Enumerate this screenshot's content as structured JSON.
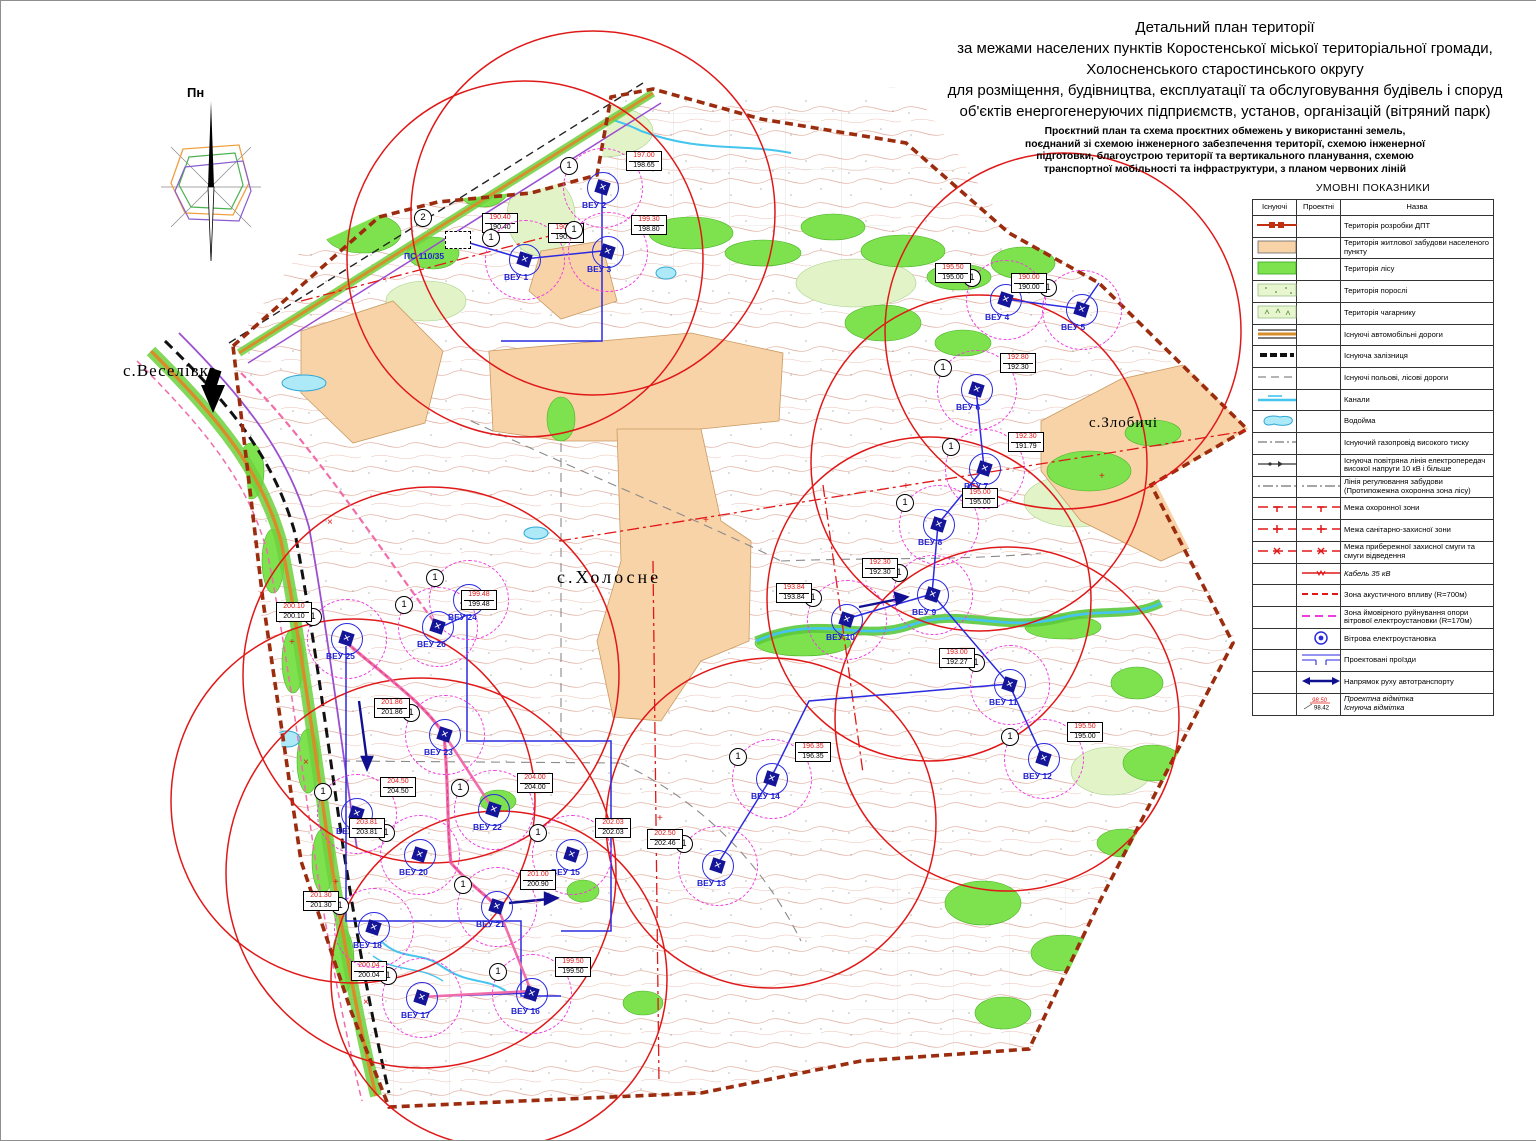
{
  "title_block": {
    "lines": [
      "Детальний план території",
      "за межами населених пунктів Коростенської міської територіальної громади,",
      "Холосненського старостинського округу",
      "для розміщення, будівництва, експлуатації та обслуговування будівель і споруд",
      "об'єктів енергогенеруючих підприємств, установ, організацій (вітряний парк)"
    ],
    "subtitle_lines": [
      "Проєктний план та схема проєктних обмежень у використанні земель,",
      "поєднаний зі схемою інженерного забезпечення території, схемою інженерної",
      "підготовки, благоустрою території та вертикального планування, схемою",
      "транспортної мобільності та інфраструктури, з планом червоних ліній"
    ]
  },
  "compass": {
    "label": "Пн"
  },
  "legend": {
    "title": "УМОВНІ ПОКАЗНИКИ",
    "columns": [
      "Існуючі",
      "Проектні",
      "Назва"
    ],
    "elevation_example": {
      "proj": "98.50",
      "exist": "98.42"
    },
    "rows": [
      {
        "ex": "dpt",
        "pr": null,
        "name": "Територія розробки ДПТ"
      },
      {
        "ex": "fillPeach",
        "pr": null,
        "name": "Територія житлової забудови населеного пункту"
      },
      {
        "ex": "fillForest",
        "pr": null,
        "name": "Територія лісу"
      },
      {
        "ex": "fillPorosl",
        "pr": null,
        "name": "Територія порослі"
      },
      {
        "ex": "fillShrub",
        "pr": null,
        "name": "Територія чагарнику"
      },
      {
        "ex": "roadAuto",
        "pr": null,
        "name": "Існуючі автомобільні дороги"
      },
      {
        "ex": "railway",
        "pr": null,
        "name": "Існуюча залізниця"
      },
      {
        "ex": "roadField",
        "pr": null,
        "name": "Існуючі польові, лісові дороги"
      },
      {
        "ex": "canal",
        "pr": null,
        "name": "Канали"
      },
      {
        "ex": "pond",
        "pr": null,
        "name": "Водойма"
      },
      {
        "ex": "gas",
        "pr": null,
        "name": "Існуючий газопровід високого тиску"
      },
      {
        "ex": "powerline",
        "pr": null,
        "name": "Існуюча повітряна лінія електропередач високої напруги 10 кВ і більше"
      },
      {
        "ex": "regline",
        "pr": "regline",
        "name": "Лінія регулювання забудови (Протипожежна охоронна зона лісу)"
      },
      {
        "ex": "guard",
        "pr": "guard",
        "name": "Межа охоронної зони"
      },
      {
        "ex": "sanitary",
        "pr": "sanitary",
        "name": "Межа санітарно-захисної зони"
      },
      {
        "ex": "coastal",
        "pr": "coastal",
        "name": "Межа прибережної захисної смуги та смуги відведення"
      },
      {
        "ex": null,
        "pr": "cable",
        "name": "Кабель 35 кВ",
        "italic": true
      },
      {
        "ex": null,
        "pr": "acoustic",
        "name": "Зона акустичного впливу (R=700м)"
      },
      {
        "ex": null,
        "pr": "rupture",
        "name": "Зона ймовірного руйнування опори вітрової електроустановки (R=170м)"
      },
      {
        "ex": null,
        "pr": "turbine",
        "name": "Вітрова електроустановка"
      },
      {
        "ex": null,
        "pr": "drive",
        "name": "Проектовані проїзди"
      },
      {
        "ex": null,
        "pr": "arrow",
        "name": "Напрямок руху автотранспорту"
      },
      {
        "ex": null,
        "pr": "elev",
        "name": "Проектна відмітка\nІснуюча відмітка",
        "italic": true
      }
    ]
  },
  "map": {
    "labels": {
      "veselivka": "с.Веселівка",
      "kholosne": "с.Холосне",
      "zlobychi": "с.Злобичі"
    },
    "substation": {
      "label": "ПС 110/35",
      "badge": "2",
      "elev_proj": "190.40",
      "elev_exist": "190.40"
    },
    "turbine_badge": "1",
    "turbines": [
      {
        "name": "ВЕУ 1",
        "x": 523,
        "y": 258,
        "proj": "190.50",
        "exist": "190.00"
      },
      {
        "name": "ВЕУ 2",
        "x": 601,
        "y": 186,
        "proj": "197.00",
        "exist": "198.65"
      },
      {
        "name": "ВЕУ 3",
        "x": 606,
        "y": 250,
        "proj": "199.30",
        "exist": "198.80"
      },
      {
        "name": "ВЕУ 4",
        "x": 1004,
        "y": 298,
        "proj": "195.50",
        "exist": "195.00",
        "box_side": "left"
      },
      {
        "name": "ВЕУ 5",
        "x": 1080,
        "y": 308,
        "proj": "190.00",
        "exist": "190.00",
        "box_side": "left"
      },
      {
        "name": "ВЕУ 6",
        "x": 975,
        "y": 388,
        "proj": "192.80",
        "exist": "192.30"
      },
      {
        "name": "ВЕУ 7",
        "x": 983,
        "y": 467,
        "proj": "192.30",
        "exist": "191.79"
      },
      {
        "name": "ВЕУ 8",
        "x": 937,
        "y": 523,
        "proj": "195.00",
        "exist": "195.00"
      },
      {
        "name": "ВЕУ 9",
        "x": 931,
        "y": 593,
        "proj": "192.30",
        "exist": "192.30",
        "box_side": "left"
      },
      {
        "name": "ВЕУ 10",
        "x": 845,
        "y": 618,
        "proj": "193.84",
        "exist": "193.84",
        "box_side": "left"
      },
      {
        "name": "ВЕУ 11",
        "x": 1008,
        "y": 683,
        "proj": "193.00",
        "exist": "192.27",
        "box_side": "left"
      },
      {
        "name": "ВЕУ 12",
        "x": 1042,
        "y": 757,
        "proj": "195.50",
        "exist": "195.00"
      },
      {
        "name": "ВЕУ 13",
        "x": 716,
        "y": 864,
        "proj": "202.50",
        "exist": "202.46",
        "box_side": "left"
      },
      {
        "name": "ВЕУ 14",
        "x": 770,
        "y": 777,
        "proj": "196.35",
        "exist": "196.35"
      },
      {
        "name": "ВЕУ 15",
        "x": 570,
        "y": 853,
        "proj": "202.03",
        "exist": "202.03"
      },
      {
        "name": "ВЕУ 16",
        "x": 530,
        "y": 992,
        "proj": "199.50",
        "exist": "199.50"
      },
      {
        "name": "ВЕУ 17",
        "x": 420,
        "y": 996,
        "proj": "200.04",
        "exist": "200.04",
        "box_side": "left"
      },
      {
        "name": "ВЕУ 18",
        "x": 372,
        "y": 926,
        "proj": "201.30",
        "exist": "201.30",
        "box_side": "left"
      },
      {
        "name": "ВЕУ 19",
        "x": 355,
        "y": 812,
        "proj": "204.50",
        "exist": "204.50"
      },
      {
        "name": "ВЕУ 20",
        "x": 418,
        "y": 853,
        "proj": "203.81",
        "exist": "203.81",
        "box_side": "left"
      },
      {
        "name": "ВЕУ 21",
        "x": 495,
        "y": 905,
        "proj": "201.00",
        "exist": "200.90"
      },
      {
        "name": "ВЕУ 22",
        "x": 492,
        "y": 808,
        "proj": "204.00",
        "exist": "204.00"
      },
      {
        "name": "ВЕУ 23",
        "x": 443,
        "y": 733,
        "proj": "201.86",
        "exist": "201.86",
        "box_side": "left"
      },
      {
        "name": "ВЕУ 24",
        "x": 467,
        "y": 598,
        "proj": null,
        "exist": null
      },
      {
        "name": "ВЕУ 25",
        "x": 345,
        "y": 637,
        "proj": "200.10",
        "exist": "200.10",
        "box_side": "left"
      },
      {
        "name": "ВЕУ 26",
        "x": 436,
        "y": 625,
        "proj": "199.48",
        "exist": "199.48"
      }
    ],
    "colors": {
      "acoustic_zone": "#e01818",
      "rupture_zone": "#ef3cdf",
      "forest": "#7de24d",
      "built_up": "#f8d3a8",
      "dpt_boundary": "#9c2c0e",
      "turbine_blue": "#2a2ae0",
      "cable_pink": "#f06daa",
      "water": "#45c5ee"
    }
  }
}
